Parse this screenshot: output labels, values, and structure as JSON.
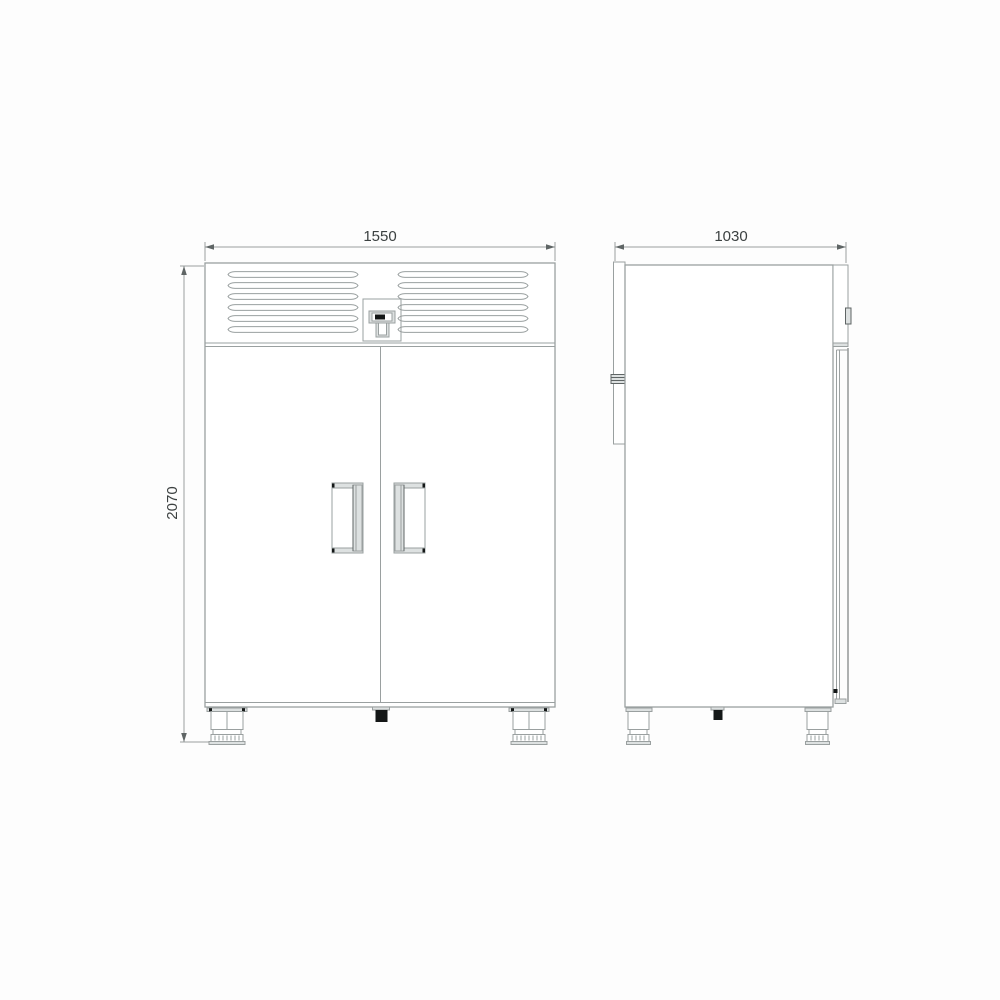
{
  "drawing": {
    "kind": "technical-dimension-drawing",
    "subject": "two-door upright commercial refrigerator, front and side elevations",
    "views": [
      {
        "id": "front",
        "dimensions": [
          {
            "axis": "width",
            "value": "1550"
          },
          {
            "axis": "height",
            "value": "2070"
          }
        ]
      },
      {
        "id": "side",
        "dimensions": [
          {
            "axis": "depth",
            "value": "1030"
          }
        ]
      }
    ],
    "parts": [
      "ventilation-louvers",
      "control-panel-display",
      "left-door",
      "right-door",
      "left-door-handle",
      "right-door-handle",
      "adjustable-feet",
      "center-drain",
      "door-hinge",
      "rear-spacer-strip"
    ],
    "colors": {
      "line": "#9aa0a0",
      "line_dark": "#5f6565",
      "fill_light": "#dde1e1",
      "fill_dark": "#141717",
      "text": "#3c4141",
      "background": "#fdfdfd"
    }
  }
}
